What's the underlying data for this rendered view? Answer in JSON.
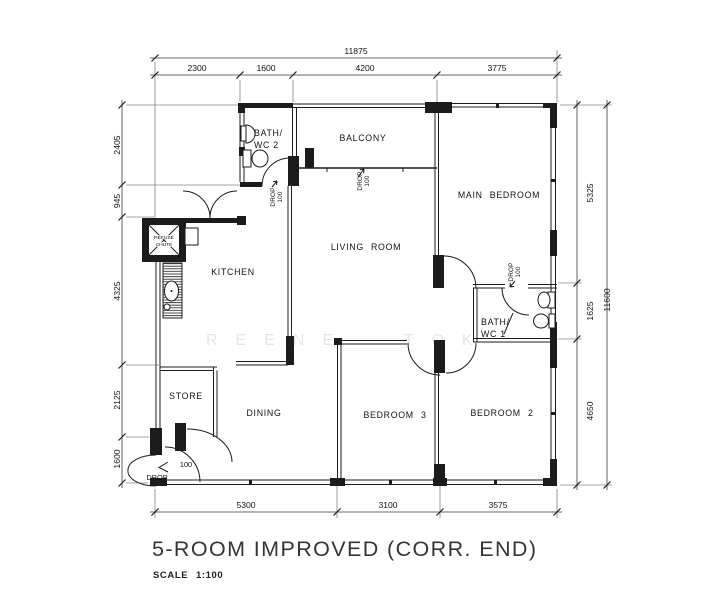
{
  "title_block": {
    "title": "5-ROOM IMPROVED (CORR. END)",
    "scale_label": "SCALE",
    "scale_value": "1:100"
  },
  "watermark": {
    "part1": "REENE",
    "part2": "TOK"
  },
  "rooms": {
    "balcony": "BALCONY",
    "living": "LIVING ROOM",
    "kitchen": "KITCHEN",
    "dining": "DINING",
    "main_bedroom": "MAIN BEDROOM",
    "bedroom2": "BEDROOM 2",
    "bedroom3": "BEDROOM 3",
    "store": "STORE",
    "bath1_line1": "BATH/",
    "bath1_line2": "WC 1",
    "bath2_line1": "BATH/",
    "bath2_line2": "WC 2",
    "refuse_line1": "REFUSE",
    "refuse_line2": "CHUTE"
  },
  "annotations": {
    "drop_word": "DROP",
    "drop_value": "100",
    "entrance_value": "100",
    "entrance_word": "DROP"
  },
  "dimensions": {
    "top_total": "11875",
    "top_segments": [
      "2300",
      "1600",
      "4200",
      "3775"
    ],
    "left_segments": [
      "2405",
      "945",
      "4325",
      "2125",
      "1600"
    ],
    "right_segments": [
      "5325",
      "1625",
      "4650"
    ],
    "right_total": "11600",
    "bottom_segments": [
      "5300",
      "3100",
      "3575"
    ]
  },
  "colors": {
    "line": "#1c1c1c",
    "background": "#ffffff",
    "watermark": "rgba(0,0,0,0.10)"
  }
}
